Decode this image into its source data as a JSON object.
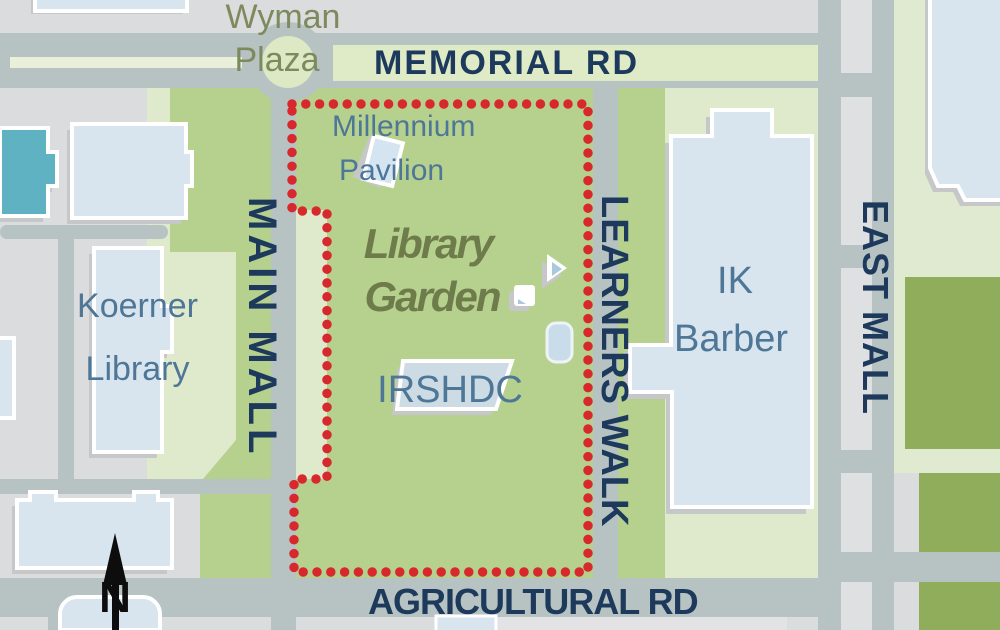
{
  "map": {
    "streets": {
      "memorial_rd": "MEMORIAL RD",
      "main_mall": "MAIN MALL",
      "learners_walk": "LEARNERS WALK",
      "east_mall": "EAST MALL",
      "agricultural_rd": "AGRICULTURAL RD"
    },
    "places": {
      "wyman_plaza": {
        "line1": "Wyman",
        "line2": "Plaza"
      },
      "millennium_pavilion": {
        "line1": "Millennium",
        "line2": "Pavilion"
      },
      "library_garden": {
        "line1": "Library",
        "line2": "Garden"
      },
      "irshdc": "IRSHDC",
      "koerner_library": {
        "line1": "Koerner",
        "line2": "Library"
      },
      "ik_barber": {
        "line1": "IK",
        "line2": "Barber"
      }
    },
    "compass": {
      "north_label": "N"
    },
    "colors": {
      "background": "#dbdcdd",
      "road": "#b7c3c3",
      "road_median": "#dfe0e2",
      "lawn_green": "#b6d08e",
      "pale_green": "#dfe9cc",
      "memorial_strip_green": "#dfeac6",
      "olive_block": "#8fad5b",
      "building_fill": "#d8e5ee",
      "building_outline": "#ffffff",
      "building_shadow": "#c6c7c9",
      "teal_building": "#5fb2c2",
      "boundary_red": "#d7282d",
      "street_text": "#1d3a5c",
      "place_text": "#4e7697",
      "garden_text": "#6e7b4b",
      "plaza_text": "#7c8a5e"
    }
  }
}
